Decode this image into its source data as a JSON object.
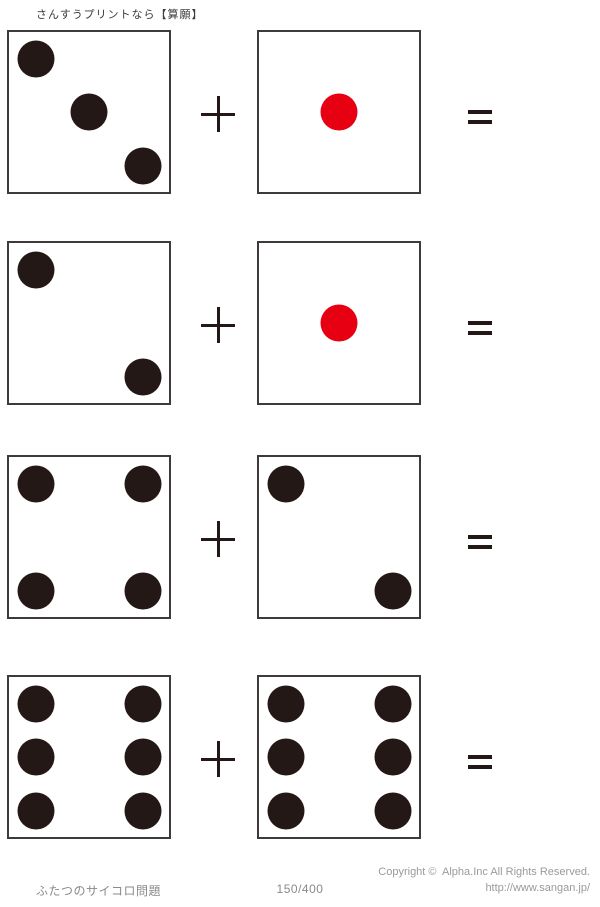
{
  "page": {
    "title": "さんすうプリントなら【算願】"
  },
  "colors": {
    "pip_black": "#231815",
    "pip_red": "#e60012",
    "border": "#3e3a39",
    "operator": "#231815",
    "title_text": "#3e3a39",
    "footer_text": "#8a8a8a",
    "copyright_text": "#9a9a9a"
  },
  "operators": {
    "plus_label": "+",
    "equals_label": "="
  },
  "problems": [
    {
      "index": 1,
      "left_die": {
        "value": 3,
        "pip_color": "black",
        "pips": [
          "top-left",
          "center",
          "bottom-right"
        ]
      },
      "right_die": {
        "value": 1,
        "pip_color": "red",
        "pips": [
          "center"
        ]
      }
    },
    {
      "index": 2,
      "left_die": {
        "value": 2,
        "pip_color": "black",
        "pips": [
          "top-left",
          "bottom-right"
        ]
      },
      "right_die": {
        "value": 1,
        "pip_color": "red",
        "pips": [
          "center"
        ]
      }
    },
    {
      "index": 3,
      "left_die": {
        "value": 4,
        "pip_color": "black",
        "pips": [
          "top-left",
          "top-right",
          "bottom-left",
          "bottom-right"
        ]
      },
      "right_die": {
        "value": 2,
        "pip_color": "black",
        "pips": [
          "top-left",
          "bottom-right"
        ]
      }
    },
    {
      "index": 4,
      "left_die": {
        "value": 6,
        "pip_color": "black",
        "pips": [
          "top-left",
          "top-right",
          "middle-left",
          "middle-right",
          "bottom-left",
          "bottom-right"
        ]
      },
      "right_die": {
        "value": 6,
        "pip_color": "black",
        "pips": [
          "top-left",
          "top-right",
          "middle-left",
          "middle-right",
          "bottom-left",
          "bottom-right"
        ]
      }
    }
  ],
  "footer": {
    "worksheet_name": "ふたつのサイコロ問題",
    "page_number": "150/400",
    "copyright_line1": "Copyright ©  Alpha.Inc All Rights Reserved.",
    "copyright_line2": "http://www.sangan.jp/"
  }
}
